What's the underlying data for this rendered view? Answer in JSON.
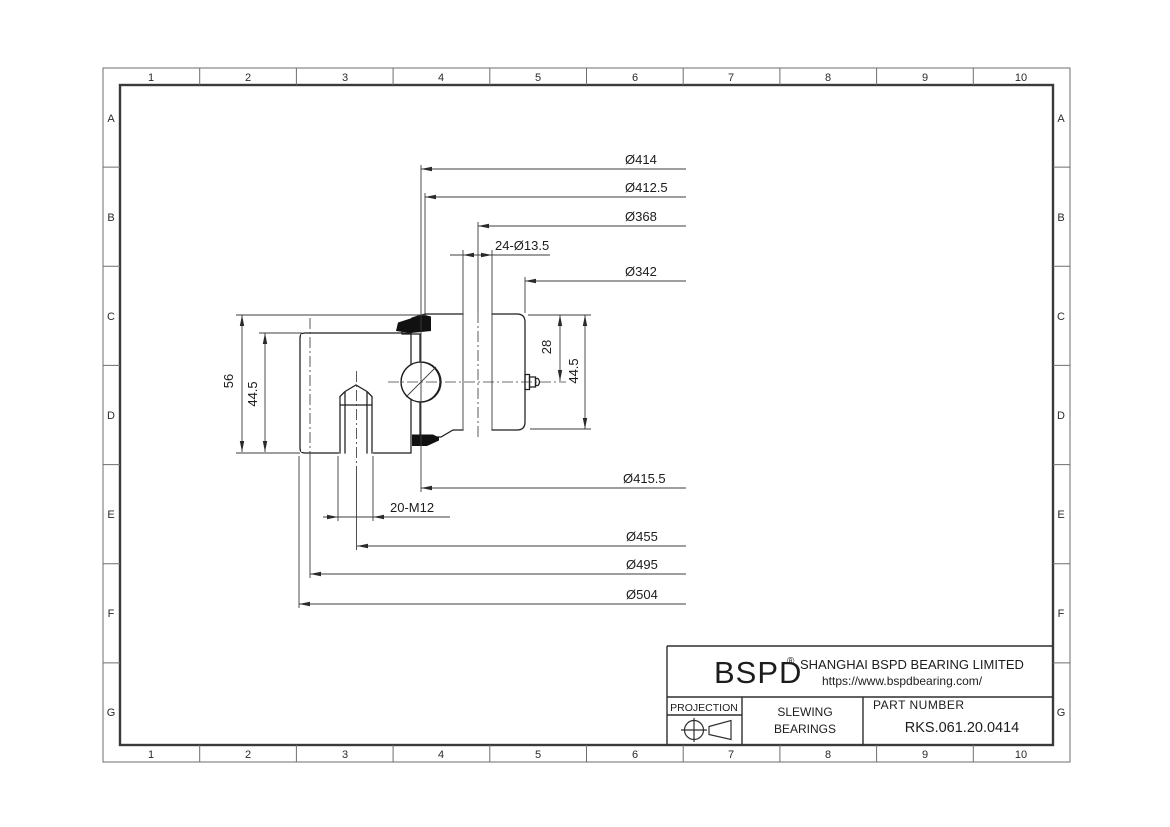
{
  "grid": {
    "cols": [
      "1",
      "2",
      "3",
      "4",
      "5",
      "6",
      "7",
      "8",
      "9",
      "10"
    ],
    "rows": [
      "A",
      "B",
      "C",
      "D",
      "E",
      "F",
      "G"
    ]
  },
  "dims": {
    "d414": "Ø414",
    "d412_5": "Ø412.5",
    "d368": "Ø368",
    "holes24": "24-Ø13.5",
    "d342": "Ø342",
    "d415_5": "Ø415.5",
    "m12_20": "20-M12",
    "d455": "Ø455",
    "d495": "Ø495",
    "d504": "Ø504",
    "h56": "56",
    "h44_5_left": "44.5",
    "h28": "28",
    "h44_5_right": "44.5"
  },
  "title_block": {
    "brand": "BSPD",
    "reg": "®",
    "company": "SHANGHAI BSPD BEARING LIMITED",
    "website": "https://www.bspdbearing.com/",
    "projection_label": "PROJECTION",
    "product_line1": "SLEWING",
    "product_line2": "BEARINGS",
    "part_number_label": "PART  NUMBER",
    "part_number": "RKS.061.20.0414"
  },
  "colors": {
    "line": "#1e1e1e",
    "dim_line": "#3c3c3c",
    "hatch": "#5f5f5f",
    "seal": "#111111",
    "background": "#ffffff"
  }
}
